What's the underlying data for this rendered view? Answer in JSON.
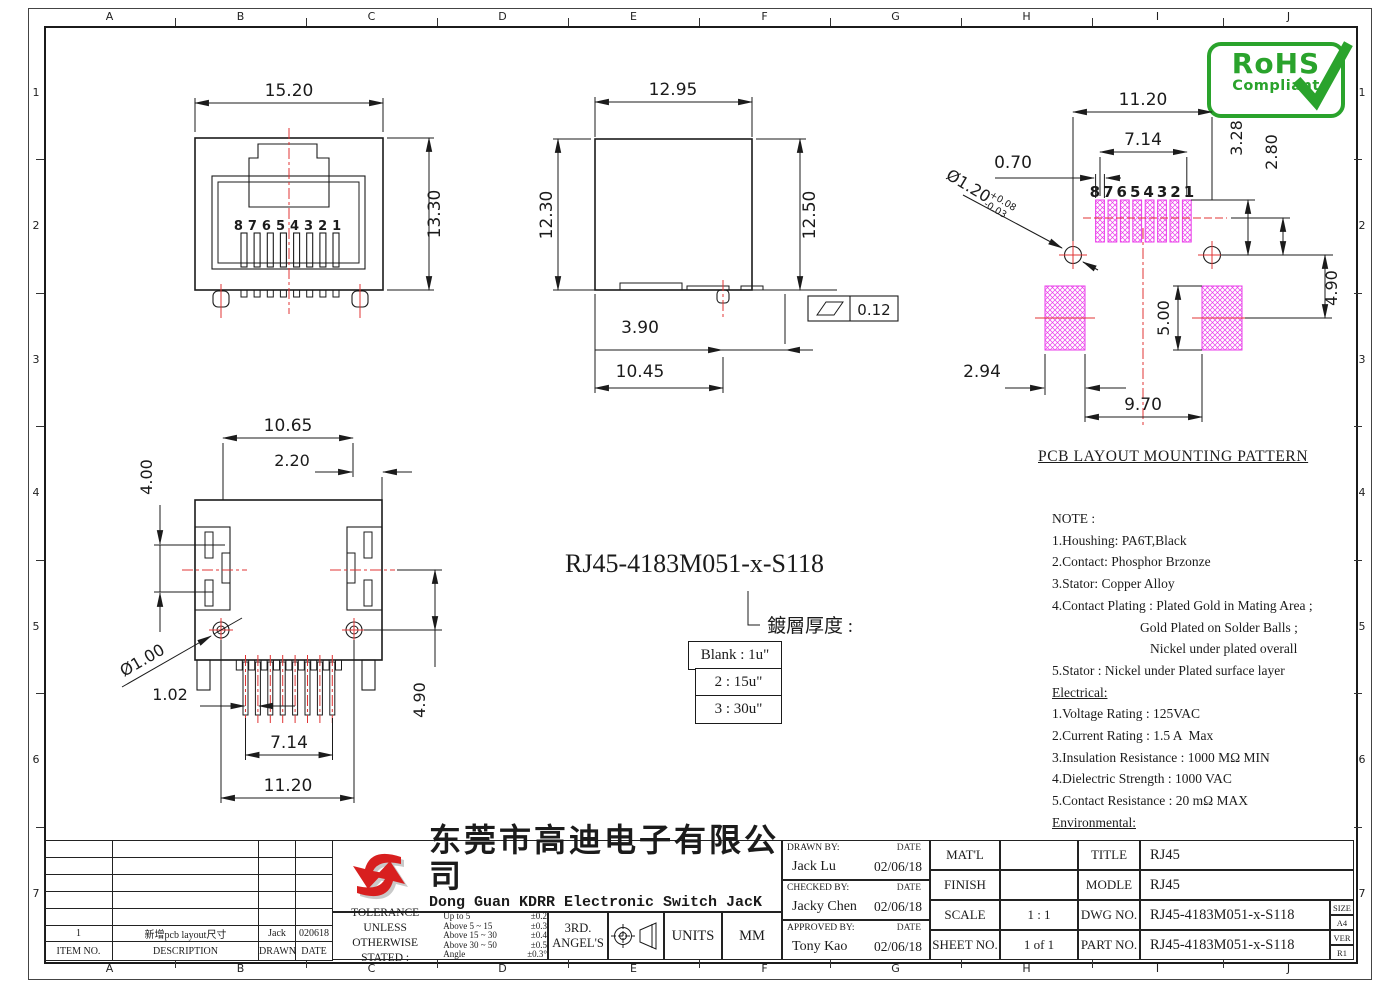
{
  "grid": {
    "cols": [
      "A",
      "B",
      "C",
      "D",
      "E",
      "F",
      "G",
      "H",
      "I",
      "J"
    ],
    "rows": [
      "1",
      "2",
      "3",
      "4",
      "5",
      "6",
      "7"
    ]
  },
  "rohs": {
    "line1": "RoHS",
    "line2": "Compliant"
  },
  "front_view": {
    "dim_width": "15.20",
    "dim_height": "13.30",
    "pins": "87654321"
  },
  "side_view": {
    "dim_width": "12.95",
    "dim_height_left": "12.30",
    "dim_height_right": "12.50",
    "dim_post": "3.90",
    "dim_overall": "10.45",
    "flatness_value": "0.12"
  },
  "pcb_view": {
    "dim_span": "11.20",
    "dim_row": "7.14",
    "dim_pad_width": "0.70",
    "hole_dia": "Ø1.20",
    "hole_tol_up": "+0.08",
    "hole_tol_dn": "-0.03",
    "dim_pad_top": "3.28",
    "dim_pad_center": "2.80",
    "dim_hole_pad": "4.90",
    "dim_pad_height": "5.00",
    "dim_pad_w": "2.94",
    "dim_pad_span": "9.70",
    "pins": "87654321"
  },
  "bottom_view": {
    "dim_width": "10.65",
    "dim_edge": "2.20",
    "dim_latch": "4.00",
    "post_dia": "Ø1.00",
    "dim_pitch": "1.02",
    "dim_row": "7.14",
    "dim_posts": "11.20",
    "dim_offset": "4.90"
  },
  "part_callout": {
    "part_number": "RJ45-4183M051-x-S118",
    "label": "鍍層厚度 :",
    "options": [
      "Blank : 1u\"",
      "2 : 15u\"",
      "3 : 30u\""
    ]
  },
  "notes": {
    "heading": "PCB LAYOUT MOUNTING PATTERN",
    "lines": [
      "NOTE :",
      "1.Houshing: PA6T,Black",
      "2.Contact: Phosphor Brzonze",
      "3.Stator: Copper Alloy",
      "4.Contact Plating : Plated Gold in Mating Area ;",
      "Gold Plated on Solder Balls ;",
      "Nickel under plated overall",
      "5.Stator : Nickel under Plated surface layer",
      "Electrical:",
      "1.Voltage Rating : 125VAC",
      "2.Current Rating : 1.5 A  Max",
      "3.Insulation Resistance : 1000 MΩ MIN",
      "4.Dielectric Strength : 1000 VAC",
      "5.Contact Resistance : 20 mΩ MAX",
      "Environmental:",
      "1.Operating Temperature  : -40°C ~ +85°C"
    ]
  },
  "revision": {
    "item": "1",
    "description": "新增pcb layout尺寸",
    "drawn": "Jack",
    "date": "020618",
    "headers": [
      "ITEM NO.",
      "DESCRIPTION",
      "DRAWN",
      "DATE"
    ]
  },
  "title_block": {
    "company_cn": "东莞市高迪电子有限公司",
    "company_en": "Dong Guan KDRR  Electronic Switch JacK Co., Ltd.",
    "tol_label1": "TOLERANCE UNLESS",
    "tol_label2": "OTHERWISE STATED :",
    "tol_rows": [
      {
        "range": "Up to 5",
        "tol": "±0.2"
      },
      {
        "range": "Above 5  ~ 15",
        "tol": "±0.3"
      },
      {
        "range": "Above 15 ~ 30",
        "tol": "±0.4"
      },
      {
        "range": "Above 30 ~ 50",
        "tol": "±0.5"
      },
      {
        "range": "Angle",
        "tol": "±0.3°"
      }
    ],
    "proj1": "3RD.",
    "proj2": "ANGEL'S",
    "units_label": "UNITS",
    "units_value": "MM",
    "drawn_label": "DRAWN BY:",
    "checked_label": "CHECKED BY:",
    "approved_label": "APPROVED BY:",
    "date_label": "DATE",
    "drawn_name": "Jack  Lu",
    "drawn_date": "02/06/18",
    "checked_name": "Jacky Chen",
    "checked_date": "02/06/18",
    "approved_name": "Tony Kao",
    "approved_date": "02/06/18",
    "matl_label": "MAT'L",
    "matl_value": "",
    "finish_label": "FINISH",
    "finish_value": "",
    "scale_label": "SCALE",
    "scale_value": "1 : 1",
    "sheet_label": "SHEET NO.",
    "sheet_value": "1 of 1",
    "title_label": "TITLE",
    "title_value": "RJ45",
    "model_label": "MODLE",
    "model_value": "RJ45",
    "dwg_label": "DWG NO.",
    "dwg_value": "RJ45-4183M051-x-S118",
    "part_label": "PART NO.",
    "part_value": "RJ45-4183M051-x-S118",
    "size_label": "SIZE",
    "size_value": "A4",
    "ver_label": "VER",
    "ver_value": "R1"
  },
  "colors": {
    "line": "#1b1b1b",
    "red": "#e03434",
    "magenta": "#ea3cea",
    "green": "#2aa32c"
  }
}
